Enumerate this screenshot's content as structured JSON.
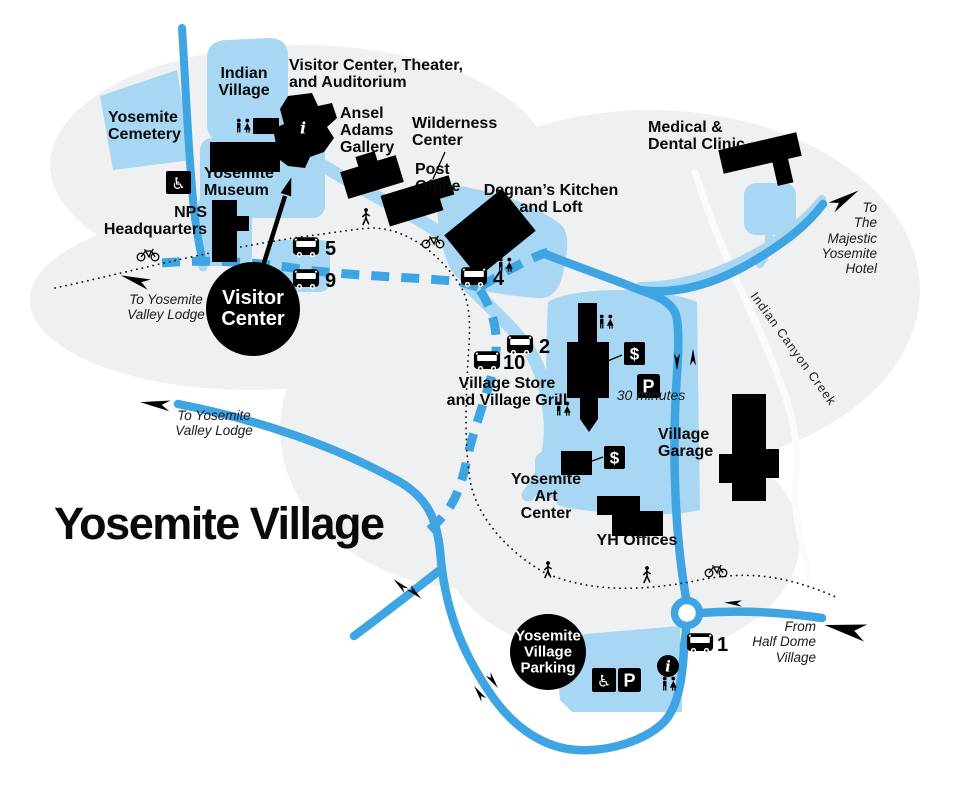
{
  "title": "Yosemite Village",
  "colors": {
    "road": "#3FA5E2",
    "walkway": "#A8D7F3",
    "building": "#000000",
    "terrain": "#EFF0F1",
    "creek": "#FAFBFC"
  },
  "labels": {
    "visitor_center_theater": "Visitor Center, Theater,\nand Auditorium",
    "indian_village": "Indian\nVillage",
    "yosemite_cemetery": "Yosemite\nCemetery",
    "yosemite_museum": "Yosemite\nMuseum",
    "nps_headquarters": "NPS\nHeadquarters",
    "ansel_adams_gallery": "Ansel\nAdams\nGallery",
    "wilderness_center": "Wilderness\nCenter",
    "post_office": "Post\nOffice",
    "degnans_kitchen": "Degnan’s Kitchen\nand Loft",
    "medical_dental": "Medical &\nDental Clinic",
    "village_store": "Village Store\nand Village Grill",
    "village_garage": "Village\nGarage",
    "yosemite_art_center": "Yosemite\nArt\nCenter",
    "yh_offices": "YH Offices",
    "visitor_center_circle": "Visitor\nCenter",
    "village_parking_circle": "Yosemite\nVillage\nParking",
    "parking_30": "30 minutes",
    "creek": "Indian Canyon Creek"
  },
  "directions": {
    "to_lodge_top": "To Yosemite\nValley Lodge",
    "to_lodge_mid": "To Yosemite\nValley Lodge",
    "to_majestic": "To\nThe\nMajestic\nYosemite\nHotel",
    "from_half_dome": "From\nHalf Dome\nVillage"
  },
  "bus_stops": [
    {
      "number": "5"
    },
    {
      "number": "9"
    },
    {
      "number": "4"
    },
    {
      "number": "2"
    },
    {
      "number": "10"
    },
    {
      "number": "1"
    }
  ],
  "icon_glyphs": {
    "info": "i",
    "parking": "P",
    "dollar": "$",
    "wheelchair": "♿"
  }
}
